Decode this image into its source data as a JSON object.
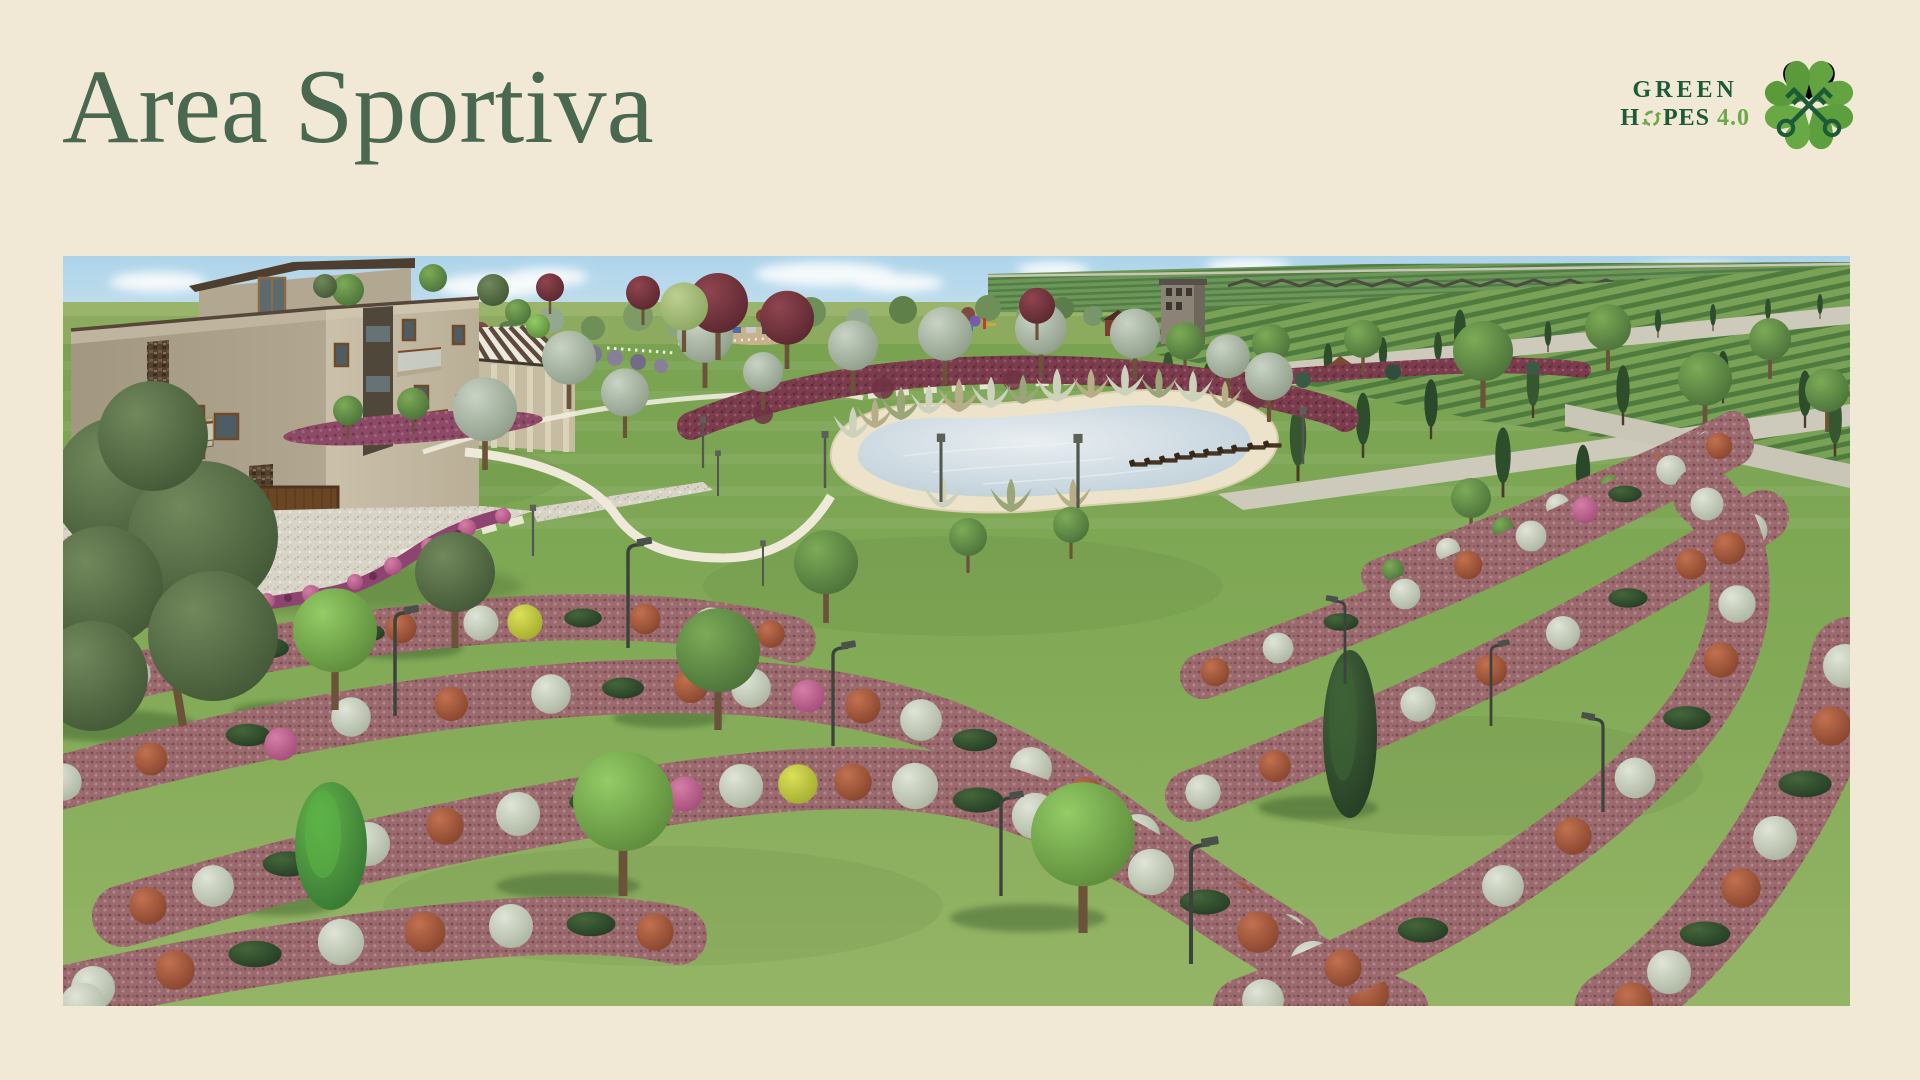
{
  "theme": {
    "background": "#f1e9d6",
    "title_color": "#4a6850",
    "logo_dark_green": "#1d5b38",
    "logo_light_green": "#6fa84c"
  },
  "title": {
    "text": "Area Sportiva"
  },
  "logo": {
    "word_green": "GREEN",
    "word_hopes_h": "H",
    "word_hopes_rest": "PES",
    "version": "4.0",
    "clover_icon": "four-leaf-clover-with-crossed-keys",
    "recycle_icon": "recycling-arrows-as-letter-o"
  }
}
